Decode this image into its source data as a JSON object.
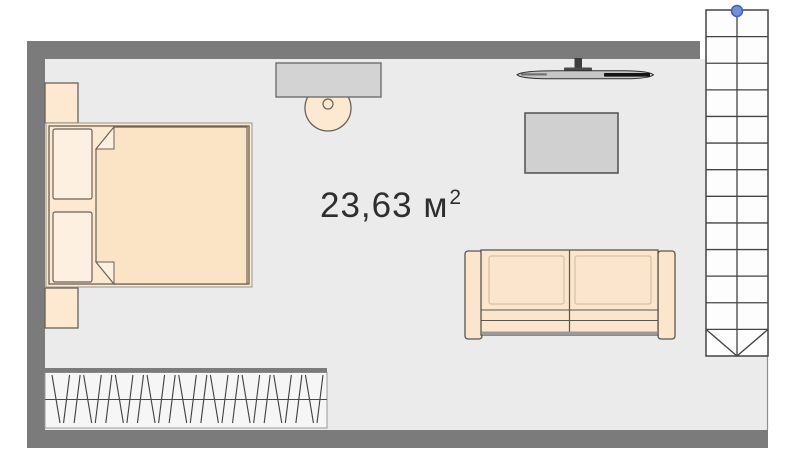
{
  "floorplan": {
    "area": {
      "value": "23,63",
      "unit": " м",
      "superscript": "2"
    },
    "stairs": {
      "steps": 13,
      "direction": "down"
    },
    "radiator": {
      "hatch_count": 26
    },
    "furniture_items": [
      "bed",
      "nightstand-top",
      "nightstand-bottom",
      "desk",
      "stool",
      "tv",
      "rug-table",
      "sofa",
      "radiator",
      "stairs"
    ],
    "colors": {
      "wall": "#7b7b7b",
      "floor": "#ebebeb",
      "furn-fill": "#fde9d2",
      "pillow-fill": "#fdf0e1",
      "blanket-fill": "#fbe3c6",
      "sofa-fill": "#fbe5cc",
      "furn-stroke": "#6b6156",
      "desk-fill": "#d3d3d3",
      "desk-stroke": "#6e6e6e",
      "table-fill": "#d0d0d0",
      "table-stroke": "#4f4f4f",
      "stairs-fill": "#fdfdfd",
      "stairs-stroke": "#444444",
      "radiator-fill": "#f6f6f6",
      "radiator-stroke": "#999999",
      "hatch-stroke": "#3f3f3f",
      "tv-dark": "#2e2e2e",
      "tv-body": "#c6c6c6",
      "handle-fill": "#7090d6",
      "handle-stroke": "#3d62b0",
      "text": "#2e2e2e"
    }
  }
}
